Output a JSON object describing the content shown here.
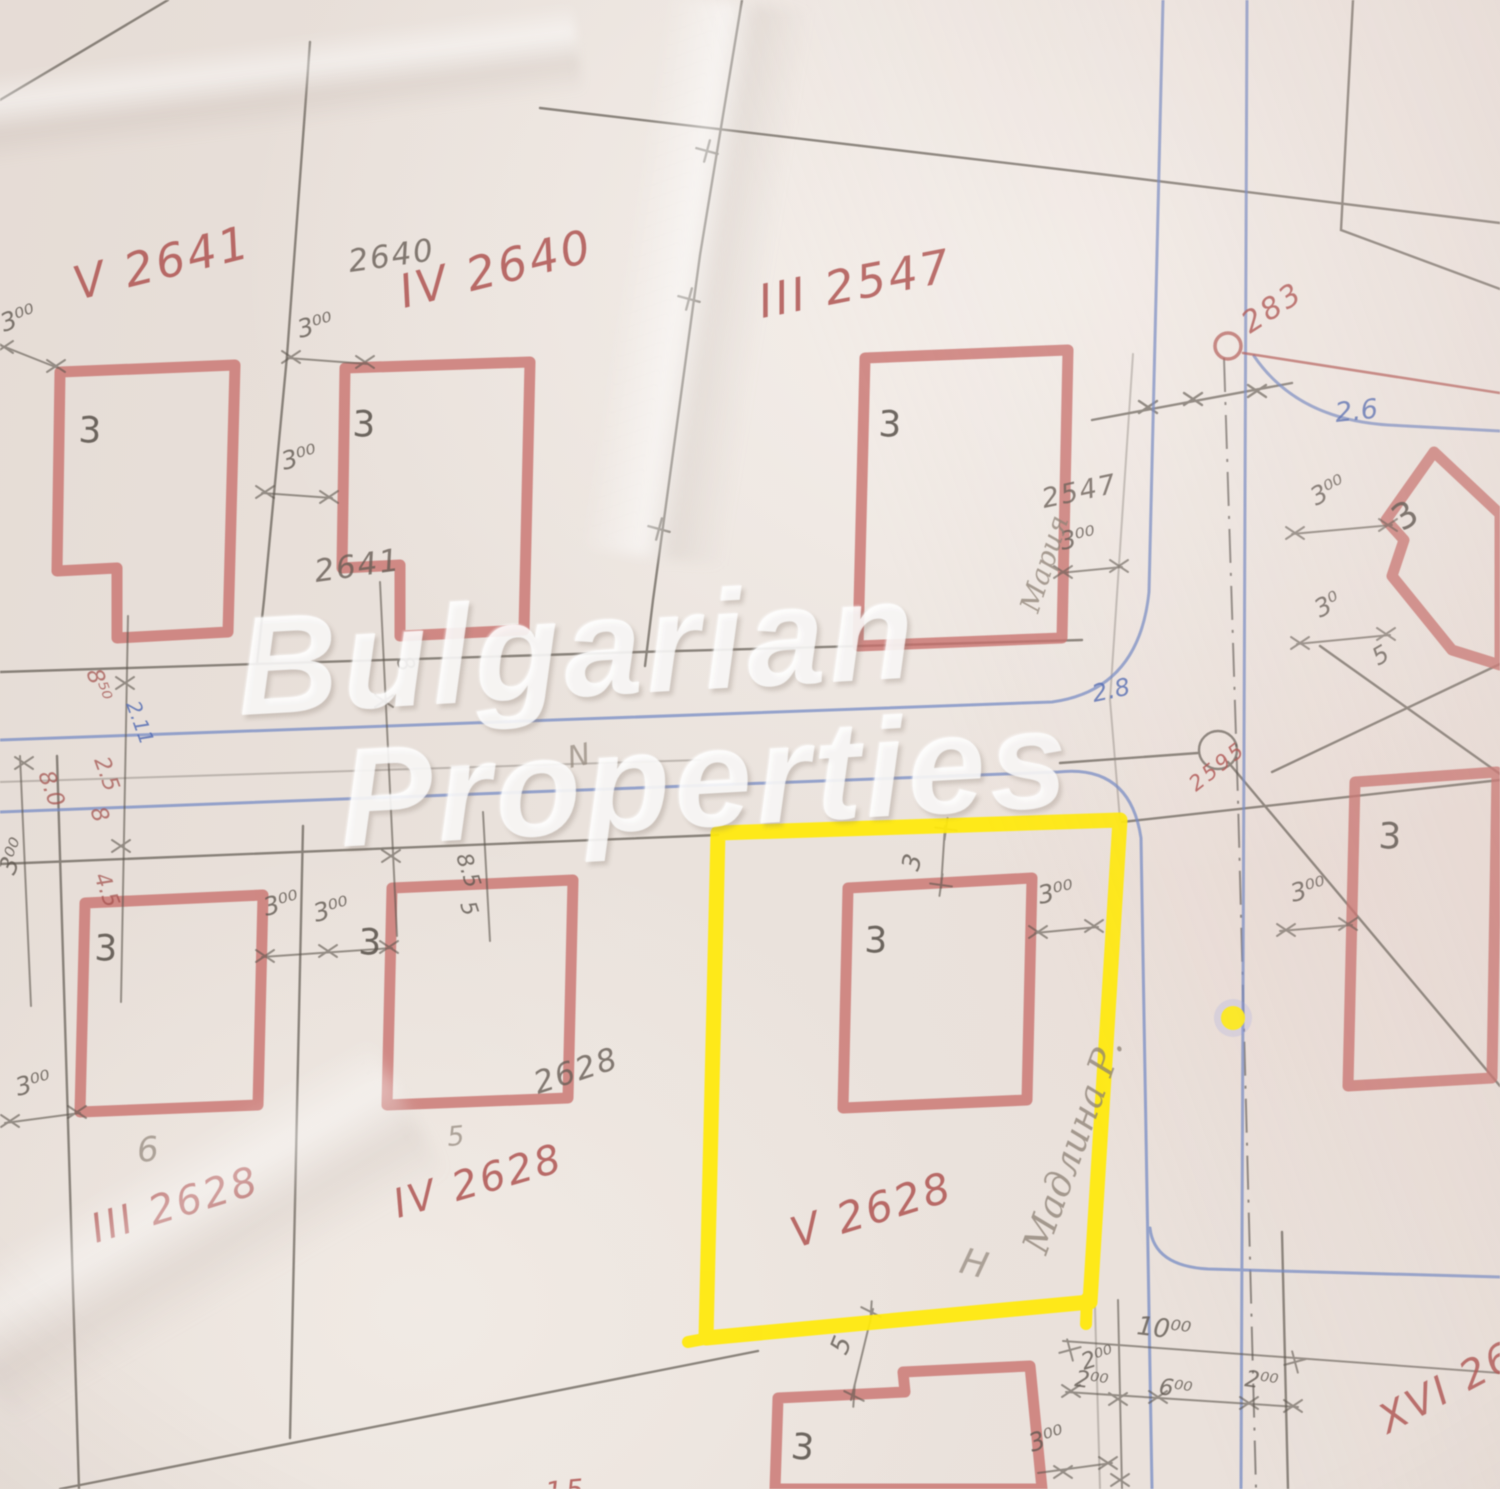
{
  "watermark": {
    "line1": "Bulgarian",
    "line2": "Properties"
  },
  "map": {
    "colors": {
      "building_red": "#c86f6b",
      "plot_label_red": "#ad4f4c",
      "pencil": "#5b544c",
      "road_blue": "#7288c4",
      "highlight_yellow": "#ffe90a"
    },
    "labels": [
      {
        "name": "plot-label-v-2641",
        "text": "V 2641",
        "x": 78,
        "y": 300,
        "rot": -14,
        "cls": "red",
        "size": 46
      },
      {
        "name": "plot-label-iv-2640",
        "text": "IV 2640",
        "x": 404,
        "y": 308,
        "rot": -14,
        "cls": "red",
        "size": 46
      },
      {
        "name": "plot-label-iii-2547",
        "text": "III 2547",
        "x": 762,
        "y": 318,
        "rot": -11,
        "cls": "red",
        "size": 46
      },
      {
        "name": "survey-point-label-283",
        "text": "283",
        "x": 1250,
        "y": 334,
        "rot": -33,
        "cls": "red",
        "size": 30
      },
      {
        "name": "plot-label-iii-2628",
        "text": "III 2628",
        "x": 96,
        "y": 1243,
        "rot": -17,
        "cls": "red",
        "size": 40
      },
      {
        "name": "plot-label-iv-2628",
        "text": "IV 2628",
        "x": 398,
        "y": 1218,
        "rot": -16,
        "cls": "red",
        "size": 40
      },
      {
        "name": "plot-label-v-2628",
        "text": "V 2628",
        "x": 796,
        "y": 1248,
        "rot": -17,
        "cls": "red",
        "size": 42
      },
      {
        "name": "plot-label-xvi-26",
        "text": "XVI 26",
        "x": 1388,
        "y": 1434,
        "rot": -28,
        "cls": "red",
        "size": 40
      },
      {
        "name": "survey-point-label-2595",
        "text": "2595",
        "x": 1196,
        "y": 792,
        "rot": -38,
        "cls": "red",
        "size": 21
      },
      {
        "name": "red-label-15",
        "text": "15",
        "x": 546,
        "y": 1502,
        "rot": -5,
        "cls": "red",
        "size": 28
      },
      {
        "name": "pencil-label-2640",
        "text": "2640",
        "x": 350,
        "y": 272,
        "rot": -8,
        "cls": "pencil",
        "size": 31
      },
      {
        "name": "pencil-label-2641",
        "text": "2641",
        "x": 316,
        "y": 582,
        "rot": -8,
        "cls": "pencil",
        "size": 31
      },
      {
        "name": "pencil-label-2547",
        "text": "2547",
        "x": 1044,
        "y": 508,
        "rot": -12,
        "cls": "pencil",
        "size": 27
      },
      {
        "name": "pencil-label-2628",
        "text": "2628",
        "x": 538,
        "y": 1094,
        "rot": -18,
        "cls": "pencil",
        "size": 31
      },
      {
        "name": "pencil-note-6",
        "text": "6",
        "x": 138,
        "y": 1162,
        "rot": -5,
        "cls": "pencil-light",
        "size": 34
      },
      {
        "name": "pencil-note-5",
        "text": "5",
        "x": 448,
        "y": 1146,
        "rot": -5,
        "cls": "pencil-light",
        "size": 27
      },
      {
        "name": "pencil-note-h",
        "text": "H",
        "x": 958,
        "y": 1272,
        "rot": 14,
        "cls": "pencil-light",
        "size": 36
      },
      {
        "name": "pencil-note-n",
        "text": "N",
        "x": 570,
        "y": 768,
        "rot": -12,
        "cls": "pencil-light",
        "size": 30
      },
      {
        "name": "road-width-label-2-6",
        "text": "2.6",
        "x": 1336,
        "y": 422,
        "rot": -6,
        "cls": "blue",
        "size": 27
      },
      {
        "name": "road-width-label-2-8",
        "text": "2.8",
        "x": 1094,
        "y": 702,
        "rot": -12,
        "cls": "blue",
        "size": 24
      },
      {
        "name": "floors-label-b1",
        "text": "3",
        "x": 78,
        "y": 442,
        "rot": 2,
        "cls": "floor",
        "size": 36
      },
      {
        "name": "floors-label-b2",
        "text": "3",
        "x": 352,
        "y": 436,
        "rot": 2,
        "cls": "floor",
        "size": 36
      },
      {
        "name": "floors-label-b3",
        "text": "3",
        "x": 878,
        "y": 436,
        "rot": 2,
        "cls": "floor",
        "size": 36
      },
      {
        "name": "floors-label-b4",
        "text": "3",
        "x": 1402,
        "y": 532,
        "rot": -33,
        "cls": "floor",
        "size": 36
      },
      {
        "name": "floors-label-b5",
        "text": "3",
        "x": 94,
        "y": 960,
        "rot": 2,
        "cls": "floor",
        "size": 36
      },
      {
        "name": "floors-label-b6",
        "text": "3",
        "x": 358,
        "y": 954,
        "rot": 2,
        "cls": "floor",
        "size": 36
      },
      {
        "name": "floors-label-b7",
        "text": "3",
        "x": 864,
        "y": 952,
        "rot": 2,
        "cls": "floor",
        "size": 36
      },
      {
        "name": "floors-label-b8",
        "text": "3",
        "x": 1378,
        "y": 848,
        "rot": 2,
        "cls": "floor",
        "size": 36
      },
      {
        "name": "floors-label-b9",
        "text": "3",
        "x": 790,
        "y": 1458,
        "rot": 6,
        "cls": "floor",
        "size": 36
      },
      {
        "name": "dim-3-00-a",
        "text": "3⁰⁰",
        "x": 4,
        "y": 332,
        "rot": -20,
        "cls": "dim",
        "size": 25
      },
      {
        "name": "dim-3-00-b",
        "text": "3⁰⁰",
        "x": 300,
        "y": 338,
        "rot": -15,
        "cls": "dim",
        "size": 25
      },
      {
        "name": "dim-3-00-c",
        "text": "3⁰⁰",
        "x": 284,
        "y": 470,
        "rot": -15,
        "cls": "dim",
        "size": 25
      },
      {
        "name": "dim-3-00-d",
        "text": "3⁰⁰",
        "x": 1062,
        "y": 550,
        "rot": -12,
        "cls": "dim",
        "size": 25
      },
      {
        "name": "dim-3-00-e",
        "text": "3⁰⁰",
        "x": 1316,
        "y": 506,
        "rot": -28,
        "cls": "dim",
        "size": 25
      },
      {
        "name": "dim-3-0-f",
        "text": "3⁰",
        "x": 1320,
        "y": 618,
        "rot": -28,
        "cls": "dim",
        "size": 25
      },
      {
        "name": "dim-3-00-g",
        "text": "3⁰⁰",
        "x": 1293,
        "y": 902,
        "rot": -15,
        "cls": "dim",
        "size": 25
      },
      {
        "name": "dim-3-00-h",
        "text": "3⁰⁰",
        "x": 14,
        "y": 876,
        "rot": -68,
        "cls": "dim",
        "size": 25
      },
      {
        "name": "dim-3-00-i",
        "text": "3⁰⁰",
        "x": 18,
        "y": 1096,
        "rot": -15,
        "cls": "dim",
        "size": 25
      },
      {
        "name": "dim-3-00-j",
        "text": "3⁰⁰",
        "x": 266,
        "y": 916,
        "rot": -15,
        "cls": "dim",
        "size": 25
      },
      {
        "name": "dim-3-00-k",
        "text": "3⁰⁰",
        "x": 316,
        "y": 922,
        "rot": -15,
        "cls": "dim",
        "size": 25
      },
      {
        "name": "dim-3-00-l",
        "text": "3⁰⁰",
        "x": 1040,
        "y": 904,
        "rot": -12,
        "cls": "dim",
        "size": 25
      },
      {
        "name": "dim-3-above-b7",
        "text": "3",
        "x": 918,
        "y": 872,
        "rot": -75,
        "cls": "dim",
        "size": 25
      },
      {
        "name": "dim-3-00-n",
        "text": "3⁰⁰",
        "x": 1032,
        "y": 1452,
        "rot": -18,
        "cls": "dim",
        "size": 25
      },
      {
        "name": "dim-2-00-o",
        "text": "2⁰⁰",
        "x": 1084,
        "y": 1370,
        "rot": -18,
        "cls": "dim",
        "size": 23
      },
      {
        "name": "dim-5-b9",
        "text": "5",
        "x": 846,
        "y": 1356,
        "rot": -68,
        "cls": "dim",
        "size": 26
      },
      {
        "name": "dim-10-00",
        "text": "10⁰⁰",
        "x": 1136,
        "y": 1334,
        "rot": 7,
        "cls": "dim",
        "size": 26
      },
      {
        "name": "dim-2-00-q",
        "text": "2⁰⁰",
        "x": 1074,
        "y": 1386,
        "rot": 8,
        "cls": "dim",
        "size": 23
      },
      {
        "name": "dim-6-00",
        "text": "6⁰⁰",
        "x": 1158,
        "y": 1394,
        "rot": 8,
        "cls": "dim",
        "size": 23
      },
      {
        "name": "dim-2-00-r",
        "text": "2⁰⁰",
        "x": 1244,
        "y": 1386,
        "rot": 8,
        "cls": "dim",
        "size": 23
      },
      {
        "name": "dim-5-b4",
        "text": "5",
        "x": 1378,
        "y": 666,
        "rot": -30,
        "cls": "dim",
        "size": 24
      },
      {
        "name": "dim-8-50",
        "text": "8⁵⁰",
        "x": 86,
        "y": 672,
        "rot": 70,
        "cls": "red-dim",
        "size": 23
      },
      {
        "name": "dim-2-11",
        "text": "2.11",
        "x": 126,
        "y": 704,
        "rot": 70,
        "cls": "blue",
        "size": 20
      },
      {
        "name": "dim-2-5",
        "text": "2.5",
        "x": 94,
        "y": 760,
        "rot": 70,
        "cls": "red-dim",
        "size": 22
      },
      {
        "name": "dim-8-a",
        "text": "8",
        "x": 90,
        "y": 810,
        "rot": 70,
        "cls": "red-dim",
        "size": 23
      },
      {
        "name": "dim-4-5",
        "text": "4.5",
        "x": 94,
        "y": 876,
        "rot": 70,
        "cls": "red-dim",
        "size": 22
      },
      {
        "name": "dim-8-0",
        "text": "8.0",
        "x": 38,
        "y": 774,
        "rot": 70,
        "cls": "red-dim",
        "size": 23
      },
      {
        "name": "dim-8-5",
        "text": "8.5",
        "x": 456,
        "y": 856,
        "rot": 72,
        "cls": "dim",
        "size": 22
      },
      {
        "name": "dim-5-c",
        "text": "5",
        "x": 460,
        "y": 904,
        "rot": 72,
        "cls": "dim",
        "size": 22
      },
      {
        "name": "dim-8-b",
        "text": "8",
        "x": 396,
        "y": 659,
        "rot": 72,
        "cls": "dim",
        "size": 23
      },
      {
        "name": "handwriting-owner-name",
        "text": "Мадлина Р.",
        "x": 1046,
        "y": 1256,
        "rot": -70,
        "cls": "script",
        "size": 37
      },
      {
        "name": "handwriting-note-b3",
        "text": "Мария",
        "x": 1038,
        "y": 614,
        "rot": -72,
        "cls": "script",
        "size": 28
      }
    ]
  }
}
